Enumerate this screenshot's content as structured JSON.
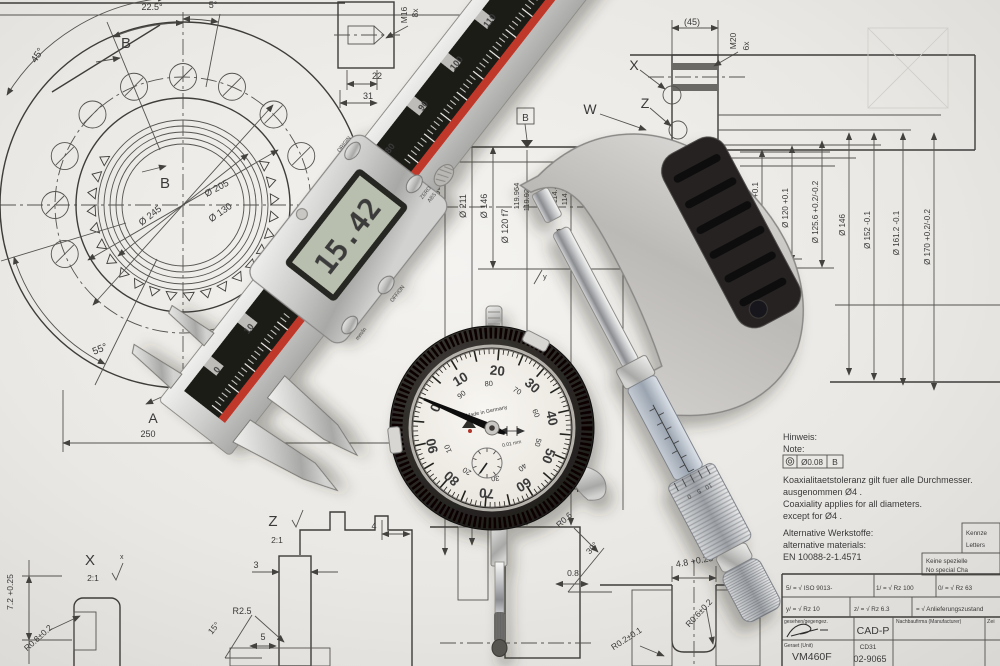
{
  "drawing": {
    "flange": {
      "angle_225": "22.5°",
      "angle_5": "5°",
      "angle_45": "45°",
      "angle_55": "55°",
      "datum_b_outer": "B",
      "datum_b_inner": "B",
      "datum_a": "A",
      "dim_250": "250",
      "dia_205": "Ø 205",
      "dia_245": "Ø 245",
      "dia_130": "Ø 130",
      "dim_height": "7.2 +0.25"
    },
    "top_detail": {
      "thread": "M16",
      "count": "8x",
      "dim_22": "22",
      "dim_31": "31"
    },
    "right_detail": {
      "dim_45": "(45)",
      "thread": "M20",
      "count": "6x",
      "label_x": "X",
      "label_z": "Z",
      "label_w": "W"
    },
    "section": {
      "dia_290": "Ø 290",
      "dia_211": "Ø 211",
      "dia_146": "Ø 146",
      "dia_120": "Ø 120 f7",
      "val_1": "119.964",
      "val_2": "119.929",
      "val_3": "114.400",
      "val_4": "114.313",
      "dia_sym": "Ø",
      "datum_b": "B",
      "surface_y": "y",
      "surface_y_big": "Y"
    },
    "right_dims": [
      "Ø 110.8 +0.1",
      "Ø 120 +0.1",
      "Ø 125.6 +0.2/-0.2",
      "Ø 146",
      "Ø 152 -0.1",
      "Ø 161.2 -0.1",
      "Ø 170 +0.2/-0.2"
    ],
    "detail_x": {
      "label": "X",
      "scale": "2:1",
      "mark": "x",
      "radius": "R0.8±0.2"
    },
    "detail_z": {
      "label": "Z",
      "scale": "2:1",
      "dim_3": "3",
      "radius": "R2.5",
      "dim_5": "5",
      "angle": "15°"
    },
    "bottom": {
      "dim_4": "4",
      "dim_25": "2.5",
      "r06": "R0.6",
      "angle_30": "30°",
      "dim_08": "0.8",
      "dim_48": "4.8 +0.25",
      "r062": "R0.6±0.2",
      "r021": "R0.2±0.1"
    },
    "note": {
      "l1": "Hinweis:",
      "l2": "Note:",
      "fcf_tol": "Ø0.08",
      "fcf_datum": "B",
      "l3": "Koaxialitaetstoleranz gilt fuer alle Durchmesser.",
      "l4": "ausgenommen Ø4 .",
      "l5": "Coaxiality applies for all diameters.",
      "l6": "except for Ø4 .",
      "m1": "Alternative Werkstoffe:",
      "m2": "alternative materials:",
      "m3": "EN 10088-2-1.4571"
    },
    "side_boxes": {
      "b1l1": "Kennze",
      "b1l2": "Letters",
      "b2l1": "Keine spezielle",
      "b2l2": "No special Cha"
    },
    "title_block": {
      "surface_marks": [
        {
          "tag": "5",
          "value": "ISO 9013-"
        },
        {
          "tag": "1",
          "value": "Rz 100"
        },
        {
          "tag": "0",
          "value": "Rz 63"
        },
        {
          "tag": "y",
          "value": "Rz 10"
        },
        {
          "tag": "z",
          "value": "Rz 6.3"
        },
        {
          "tag": "",
          "value": "Anlieferungszustand"
        }
      ],
      "approved_label": "gesehen/gegengez.",
      "cad": "CAD-P",
      "manufacturer_label": "Nachbaufirma (Manufacturer)",
      "col_right": "Zei",
      "unit_label": "Geraet (Unit)",
      "unit_value": "VM460F",
      "code_top": "CD31",
      "code_bottom": "02-9065"
    }
  },
  "caliper": {
    "lcd_value": "15.42",
    "buttons": {
      "origin": "ORIGIN",
      "zero": "ZERO",
      "abs": "ABS",
      "off_on": "OFF/ON",
      "mm_in": "mm/in"
    },
    "scale_upper": [
      "80",
      "90",
      "100",
      "110",
      "120",
      "130",
      "140"
    ],
    "scale_lower": [
      "0",
      "10"
    ]
  },
  "dial_indicator": {
    "numbers_black": [
      "0",
      "10",
      "20",
      "30",
      "40",
      "50",
      "60",
      "70",
      "80",
      "90"
    ],
    "numbers_red": [
      "90",
      "80",
      "70",
      "60",
      "50",
      "40",
      "30",
      "20",
      "10"
    ],
    "made_in": "Made in Germany",
    "resolution": "0.01 mm"
  },
  "micrometer": {
    "thimble_scale": [
      "0",
      "5",
      "10"
    ]
  },
  "colors": {
    "paper": "#ecebe7",
    "red_stripe": "#c0392b",
    "lcd_screen": "#b9bfae",
    "accent_red": "#b0342c"
  }
}
